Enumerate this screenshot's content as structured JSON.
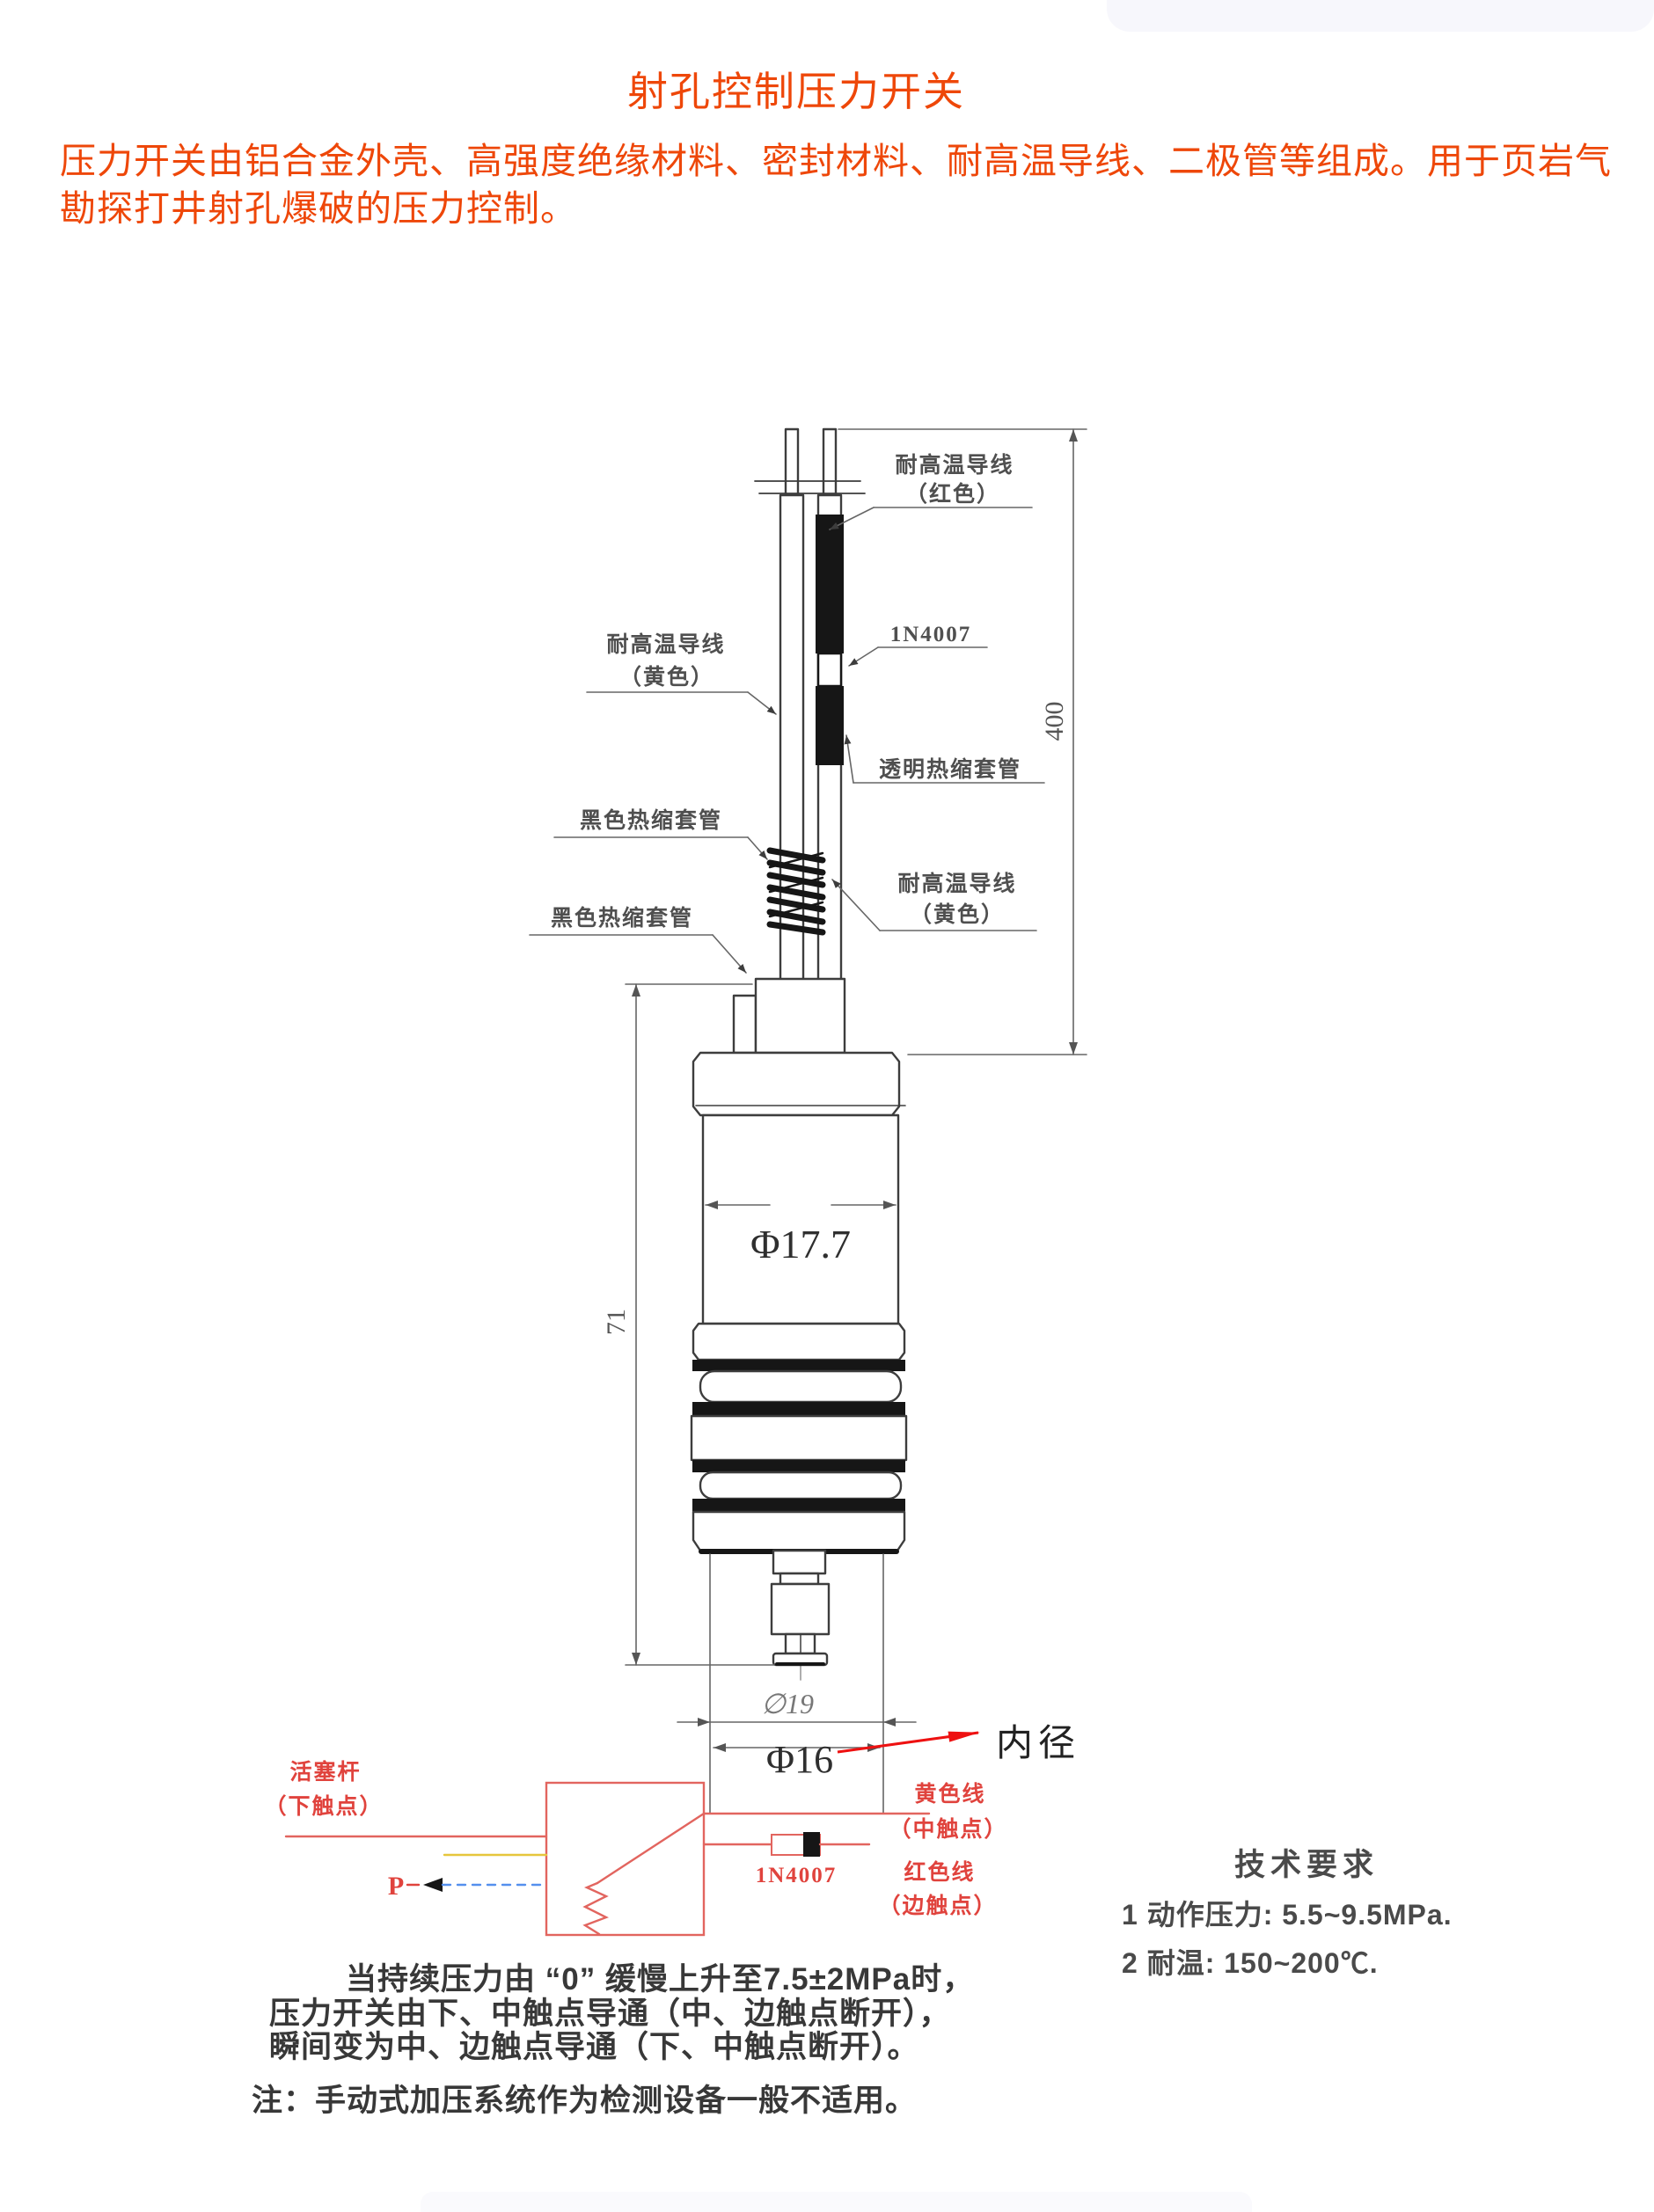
{
  "page": {
    "title": "射孔控制压力开关",
    "intro": "压力开关由铝合金外壳、高强度绝缘材料、密封材料、耐高温导线、二极管等组成。用于页岩气勘探打井射孔爆破的压力控制。"
  },
  "diagram": {
    "labels": {
      "wire_red_line1": "耐高温导线",
      "wire_red_line2": "（红色）",
      "diode": "1N4007",
      "clear_tube": "透明热缩套管",
      "wire_yellow_left_line1": "耐高温导线",
      "wire_yellow_left_line2": "（黄色）",
      "black_tube_upper": "黑色热缩套管",
      "black_tube_lower": "黑色热缩套管",
      "wire_yellow_right_line1": "耐高温导线",
      "wire_yellow_right_line2": "（黄色）"
    },
    "dimensions": {
      "lead_length": "400",
      "body_length": "71",
      "body_diameter": "Φ17.7",
      "outer_diameter": "∅19",
      "inner_diameter": "Φ16",
      "inner_diameter_label": "内径"
    }
  },
  "circuit": {
    "piston_line1": "活塞杆",
    "piston_line2": "（下触点）",
    "pressure_symbol": "P",
    "diode": "1N4007",
    "yellow_wire_line1": "黄色线",
    "yellow_wire_line2": "（中触点）",
    "red_wire_line1": "红色线",
    "red_wire_line2": "（边触点）"
  },
  "tech_requirements": {
    "heading": "技术要求",
    "item1": "1 动作压力: 5.5~9.5MPa.",
    "item2": "2 耐温: 150~200℃."
  },
  "description": {
    "line1": "当持续压力由 “0” 缓慢上升至7.5±2MPa时，",
    "line2": "压力开关由下、中触点导通（中、边触点断开），",
    "line3": "瞬间变为中、边触点导通（下、中触点断开）。",
    "note": "注：手动式加压系统作为检测设备一般不适用。"
  },
  "colors": {
    "accent_orange": "#ee4709",
    "drawing_line": "#3d3d3d",
    "circuit_red": "#e0433d",
    "pointer_red": "#ee1111"
  }
}
